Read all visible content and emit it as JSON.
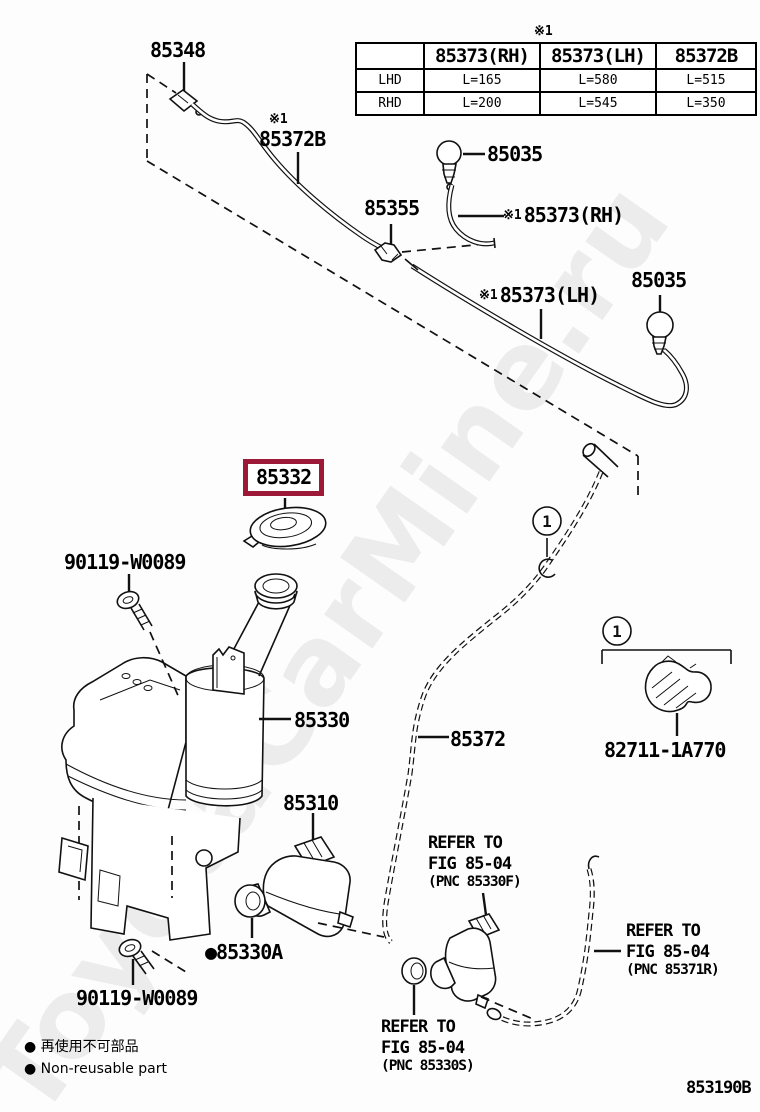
{
  "watermark": {
    "text": "ToyotaCarMine.ru"
  },
  "table": {
    "ref_mark": "※1",
    "headers": [
      "",
      "85373(RH)",
      "85373(LH)",
      "85372B"
    ],
    "rows": [
      {
        "label": "LHD",
        "values": [
          "L=165",
          "L=580",
          "L=515"
        ]
      },
      {
        "label": "RHD",
        "values": [
          "L=200",
          "L=545",
          "L=350"
        ]
      }
    ]
  },
  "labels": {
    "p85348": "85348",
    "p85372B": {
      "ref": "※1",
      "text": "85372B"
    },
    "p85035_top": "85035",
    "p85355": "85355",
    "p85373RH": {
      "ref": "※1",
      "text": "85373(RH)"
    },
    "p85373LH": {
      "ref": "※1",
      "text": "85373(LH)"
    },
    "p85035_right": "85035",
    "p85332": "85332",
    "p90119_top": "90119-W0089",
    "p85330": "85330",
    "p85372": "85372",
    "p82711": "82711-1A770",
    "p85310": "85310",
    "p85330A": {
      "bullet": "●",
      "text": "85330A"
    },
    "p90119_bottom": "90119-W0089"
  },
  "callouts": {
    "one": "1"
  },
  "refer_notes": {
    "pnc85330F": {
      "line1": "REFER TO",
      "line2": "FIG 85-04",
      "line3": "(PNC 85330F)"
    },
    "pnc85371R": {
      "line1": "REFER TO",
      "line2": "FIG 85-04",
      "line3": "(PNC 85371R)"
    },
    "pnc85330S": {
      "line1": "REFER TO",
      "line2": "FIG 85-04",
      "line3": "(PNC 85330S)"
    }
  },
  "legend": {
    "bullet": "●",
    "jp": "再使用不可部品",
    "en": "Non-reusable part"
  },
  "figure_code": "853190B",
  "colors": {
    "highlight": "#9c1a38",
    "line": "#111111",
    "watermark": "#ececec"
  }
}
